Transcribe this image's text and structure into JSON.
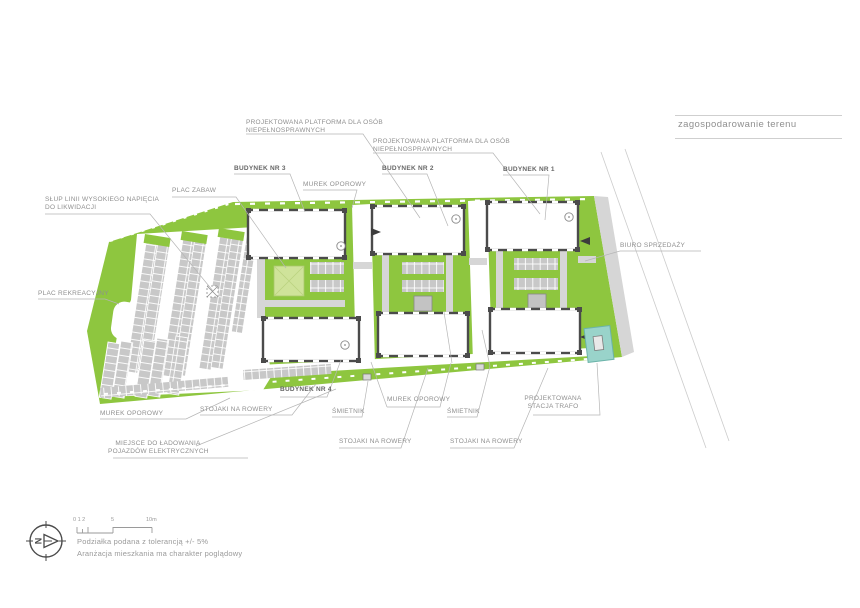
{
  "header": {
    "title": "zagospodarowanie terenu"
  },
  "labels": {
    "platform_top": {
      "line1": "PROJEKTOWANA PLATFORMA DLA OSÓB",
      "line2": "NIEPEŁNOSPRAWNYCH"
    },
    "platform_mid": {
      "line1": "PROJEKTOWANA PLATFORMA DLA OSÓB",
      "line2": "NIEPEŁNOSPRAWNYCH"
    },
    "budynek3": "BUDYNEK NR 3",
    "budynek2": "BUDYNEK NR 2",
    "budynek1": "BUDYNEK NR 1",
    "budynek4": "BUDYNEK NR 4",
    "murek_top": "MUREK OPOROWY",
    "murek_left": "MUREK OPOROWY",
    "murek_mid": "MUREK OPOROWY",
    "slup": {
      "line1": "SŁUP LINII WYSOKIEGO NAPIĘCIA",
      "line2": "DO LIKWIDACJI"
    },
    "plac_zabaw": "PLAC ZABAW",
    "plac_rekreacyjny": "PLAC REKREACYJNY",
    "biuro": "BIURO SPRZEDAŻY",
    "stojaki_left": "STOJAKI NA ROWERY",
    "stojaki_mid": "STOJAKI NA ROWERY",
    "stojaki_right": "STOJAKI NA ROWERY",
    "smietnik_left": "ŚMIETNIK",
    "smietnik_right": "ŚMIETNIK",
    "ladowanie": {
      "line1": "MIEJSCE DO ŁADOWANIA",
      "line2": "POJAZDÓW ELEKTRYCZNYCH"
    },
    "trafo": {
      "line1": "PROJEKTOWANA",
      "line2": "STACJA TRAFO"
    }
  },
  "footer": {
    "scale": {
      "t012": "0 1 2",
      "t5": "5",
      "t10": "10m"
    },
    "note1": "Podziałka podana z tolerancją +/- 5%",
    "note2": "Aranżacja mieszkania ma charakter poglądowy",
    "compass_letter": "N"
  },
  "colors": {
    "site_green": "#8ec63f",
    "playground_green": "#cfe39a",
    "path_gray": "#d6d6d6",
    "stall_gray": "#c8c8c8",
    "wall_dark": "#4b4b4b",
    "trafo_teal": "#99d3ca"
  }
}
